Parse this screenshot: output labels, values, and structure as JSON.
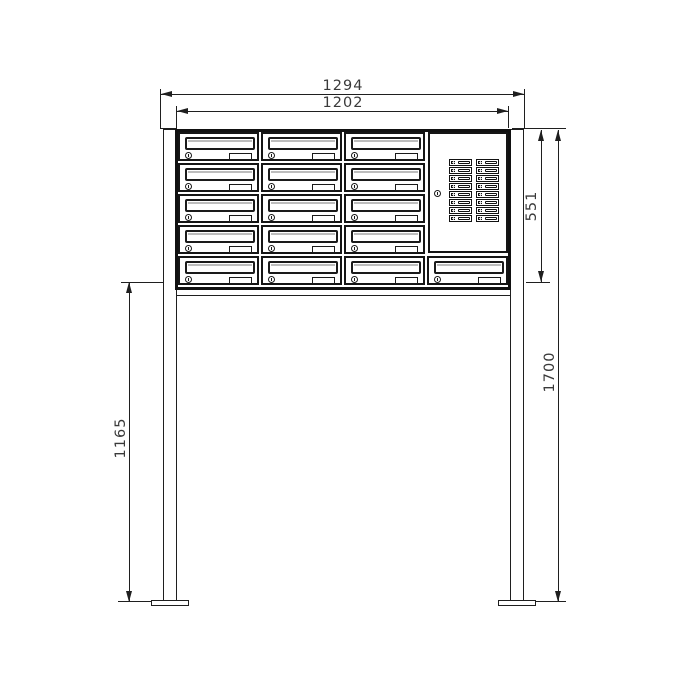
{
  "drawing": {
    "type": "technical-dimension-drawing",
    "subject": "free-standing mailbox bank (letterbox unit) on two posts with intercom bell panel",
    "background_color": "#ffffff",
    "line_color": "#1f1f1f",
    "dimensions": {
      "overall_width": {
        "label": "1294",
        "orientation": "horizontal"
      },
      "cabinet_width": {
        "label": "1202",
        "orientation": "horizontal"
      },
      "cabinet_height": {
        "label": "551",
        "orientation": "vertical"
      },
      "overall_height": {
        "label": "1700",
        "orientation": "vertical"
      },
      "stand_height": {
        "label": "1165",
        "orientation": "vertical"
      }
    },
    "cabinet": {
      "top_rows": 4,
      "top_cols": 3,
      "bottom_row_boxes": 4,
      "total_mailboxes": 16,
      "mailbox_parts": [
        "mail-slot-flap",
        "cylinder-lock",
        "name-plate"
      ]
    },
    "intercom_panel": {
      "bell_rows": 8,
      "bell_cols": 2,
      "total_bell_buttons": 16,
      "has_cylinder_lock": true
    },
    "stand": {
      "posts": 2,
      "base_plates": 2,
      "crossbar_below_cabinet": true
    }
  }
}
